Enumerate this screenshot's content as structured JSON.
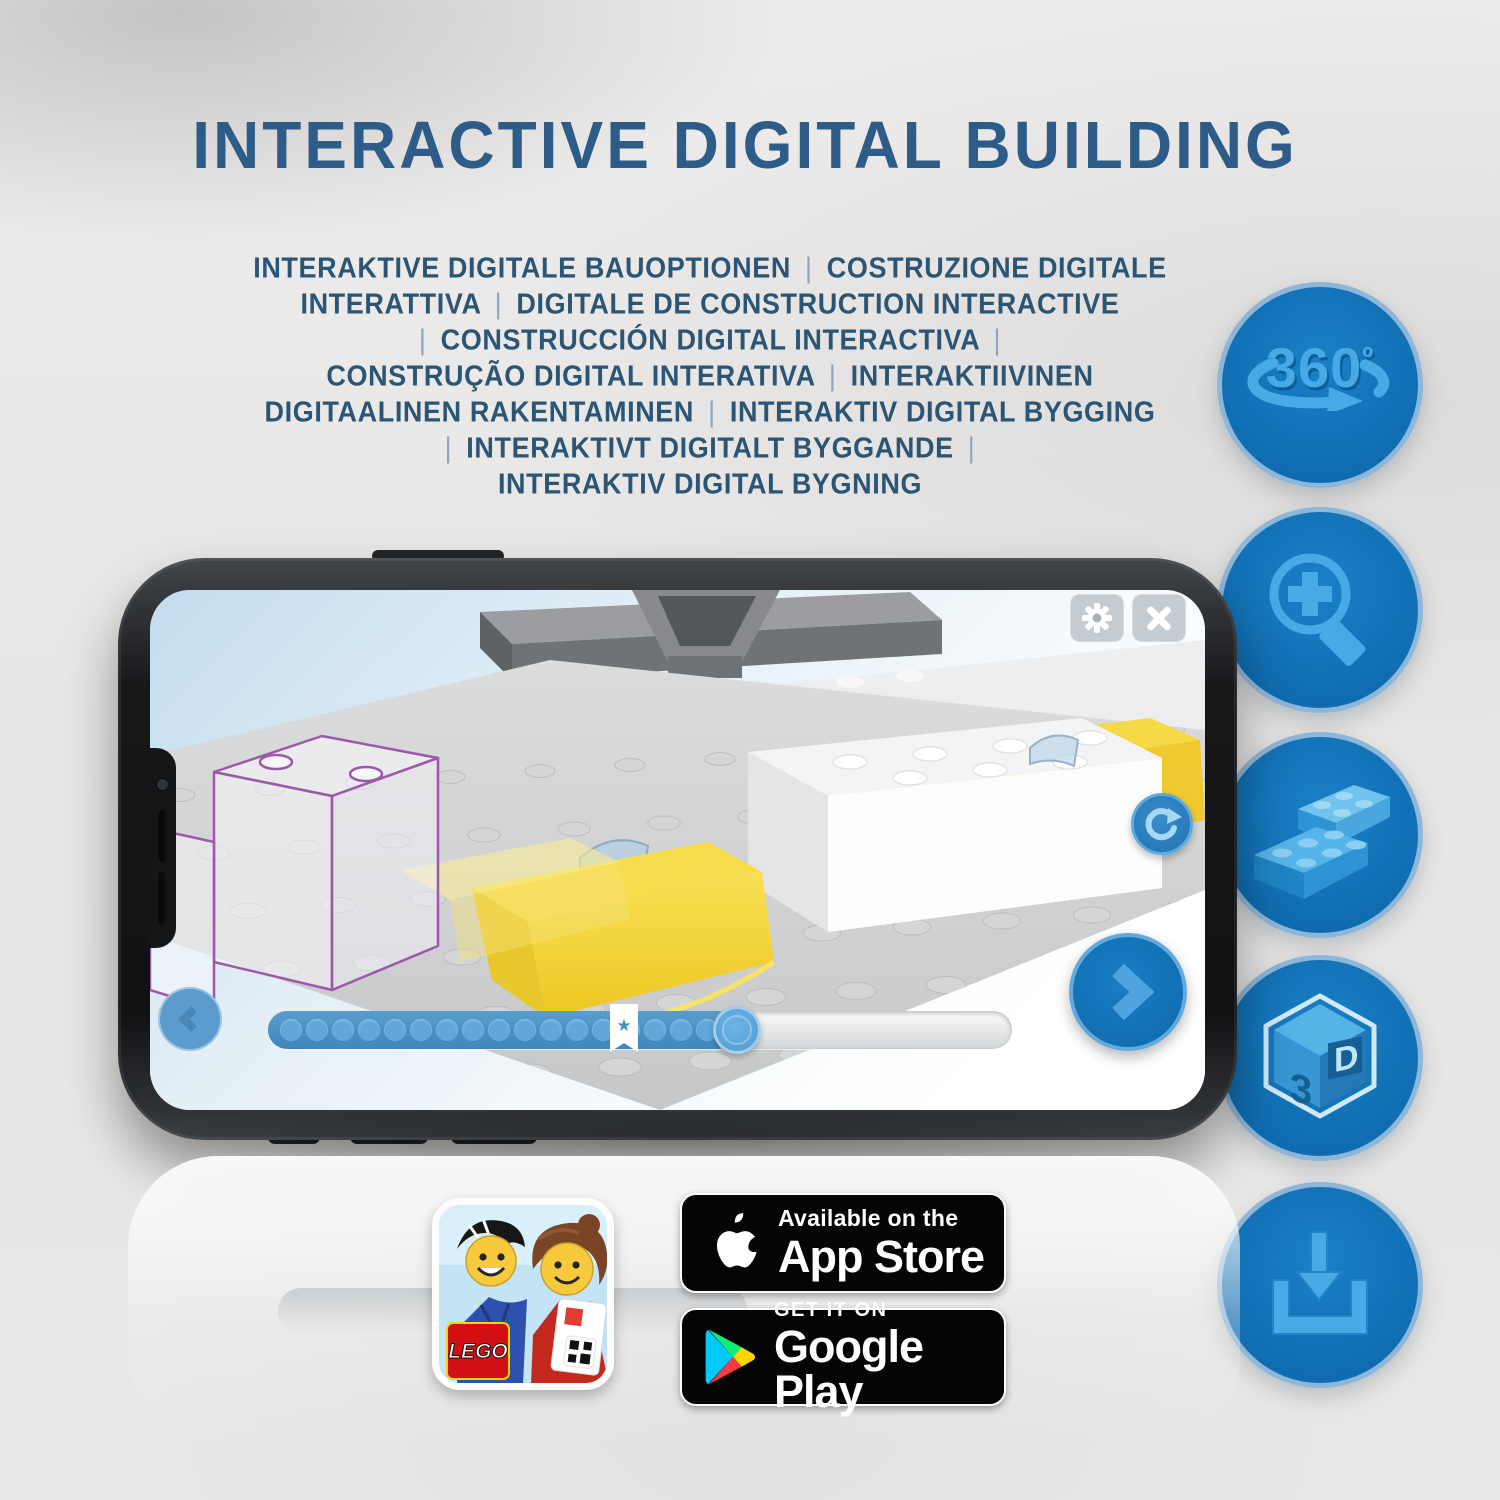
{
  "page": {
    "title": "INTERACTIVE DIGITAL BUILDING",
    "subtitle_lines": [
      "INTERAKTIVE DIGITALE BAUOPTIONEN | COSTRUZIONE DIGITALE",
      "INTERATTIVA | DIGITALE DE CONSTRUCTION INTERACTIVE",
      "| CONSTRUCCIÓN DIGITAL INTERACTIVA |",
      "CONSTRUÇÃO DIGITAL INTERATIVA | INTERAKTIIVINEN",
      "DIGITAALINEN RAKENTAMINEN | INTERAKTIV DIGITAL BYGGING",
      "| INTERAKTIVT DIGITALT BYGGANDE |",
      "INTERAKTIV DIGITAL BYGNING"
    ]
  },
  "feature_icons": {
    "rotate_360": {
      "number": "360",
      "degree": "º"
    },
    "zoom_in": {
      "name": "magnifier-plus"
    },
    "brick": {
      "name": "lego-bricks"
    },
    "cube_3d": {
      "three": "3",
      "d": "D"
    },
    "download": {
      "name": "download-tray"
    }
  },
  "phone_app": {
    "slider": {
      "progress_percent": 63,
      "bookmark_percent": 44,
      "segment_dots": 17
    },
    "icons": {
      "star": "★"
    }
  },
  "badges": {
    "app_store": {
      "line1": "Available on the",
      "line2": "App Store"
    },
    "google_play": {
      "line1": "GET IT ON",
      "line2": "Google Play"
    }
  },
  "app_icon": {
    "logo_text": "LEGO"
  },
  "colors": {
    "title": "#2d5c88",
    "subtitle": "#2b5574",
    "icon_circle": "#1173ba",
    "icon_glyph": "#47a9e6",
    "app_blue": "#1272b8",
    "slider_fill": "#4a92c8",
    "lego_yellow": "#f3d435",
    "ghost_outline": "#9d59a9"
  }
}
